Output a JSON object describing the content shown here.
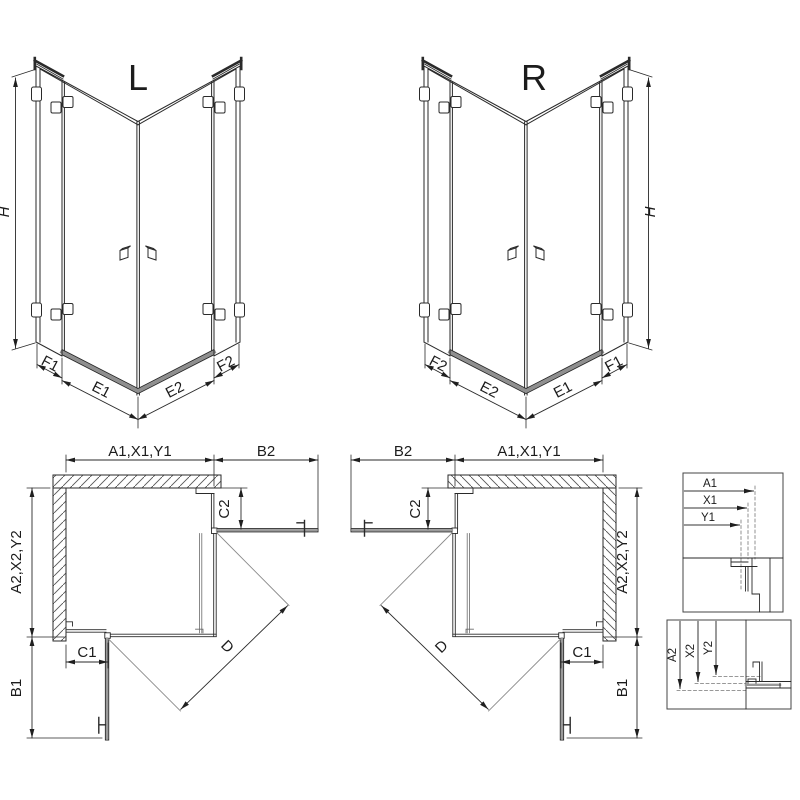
{
  "iso_left": {
    "variant_label": "L",
    "dim_height": "H",
    "dim_f1": "F1",
    "dim_e1": "E1",
    "dim_e2": "E2",
    "dim_f2": "F2"
  },
  "iso_right": {
    "variant_label": "R",
    "dim_height": "H",
    "dim_f1": "F1",
    "dim_e1": "E1",
    "dim_e2": "E2",
    "dim_f2": "F2"
  },
  "plan_left": {
    "dim_width": "A1,X1,Y1",
    "dim_b2": "B2",
    "dim_depth": "A2,X2,Y2",
    "dim_b1": "B1",
    "dim_c1": "C1",
    "dim_c2": "C2",
    "dim_d": "D"
  },
  "plan_right": {
    "dim_width": "A1,X1,Y1",
    "dim_b2": "B2",
    "dim_depth": "A2,X2,Y2",
    "dim_b1": "B1",
    "dim_c1": "C1",
    "dim_c2": "C2",
    "dim_d": "D"
  },
  "detail_horizontal": {
    "labels": [
      "A1",
      "X1",
      "Y1"
    ]
  },
  "detail_vertical": {
    "labels": [
      "A2",
      "X2",
      "Y2"
    ]
  },
  "colors": {
    "line": "#2a2a2a",
    "glass_gray": "#9a9a9a",
    "hatch": "#555555",
    "background": "#ffffff"
  }
}
